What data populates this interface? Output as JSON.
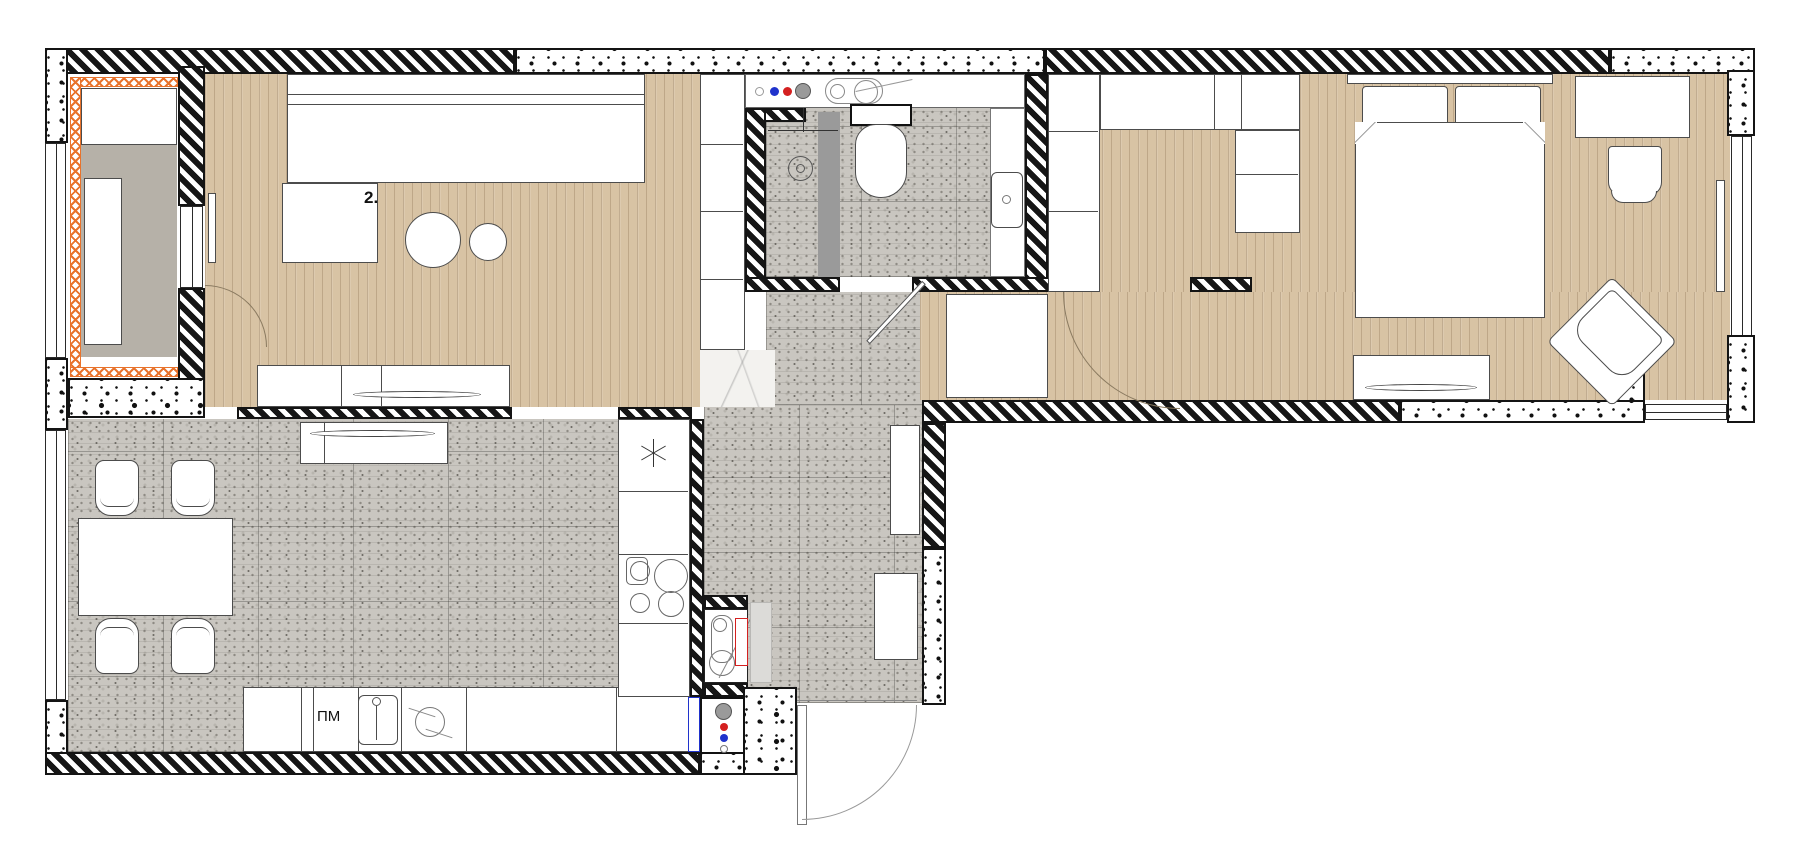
{
  "plan": {
    "room_label": "2.",
    "appliance_labels": {
      "dishwasher": "ПМ"
    },
    "colors": {
      "wall": "#141414",
      "wood": "#d8c3a4",
      "terrazzo": "#c9c6c0",
      "terrazzo_dark": "#8e8b84",
      "balcony_floor": "#b6b1a8",
      "marble": "#f3f2ef",
      "insulation": "#e8732c",
      "glass_gray": "#9a9a9a",
      "panel_gray": "#dcdbd8",
      "accent_red": "#d42020",
      "accent_blue": "#2033cc"
    }
  }
}
